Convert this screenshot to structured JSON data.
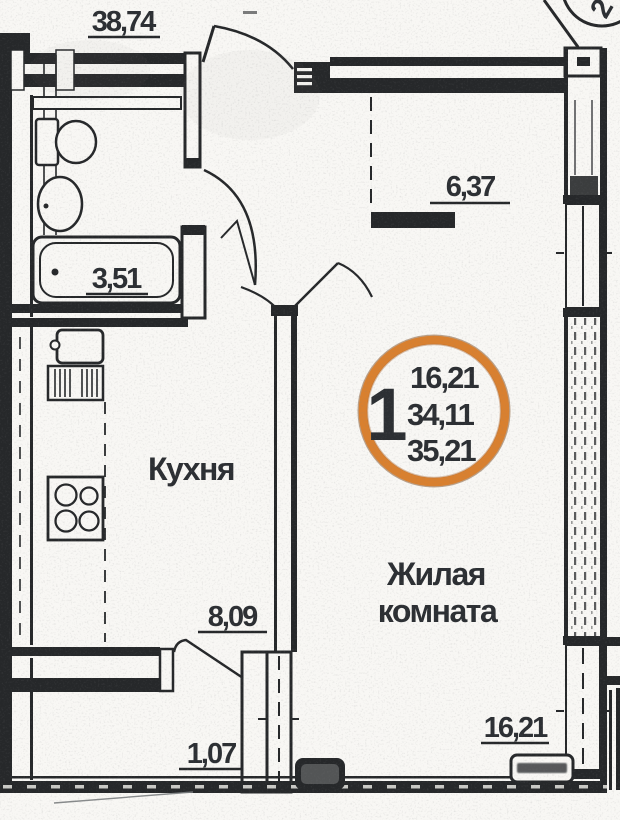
{
  "plan": {
    "top_dim": "38,74",
    "hall_dim": "6,37",
    "bath_dim": "3,51",
    "kitchen_dim": "8,09",
    "balcony_dim": "1,07",
    "living_dim": "16,21",
    "kitchen_label": "Кухня",
    "living_label_1": "Жилая",
    "living_label_2": "комната",
    "unit_badge": {
      "rooms_count": "1",
      "living_area": "16,21",
      "apartment_area": "34,11",
      "total_area": "35,21"
    },
    "adjacent_unit": "2",
    "colors": {
      "ring": "#d9802f",
      "ink": "#26282a",
      "paper": "#f8f7f4"
    }
  }
}
